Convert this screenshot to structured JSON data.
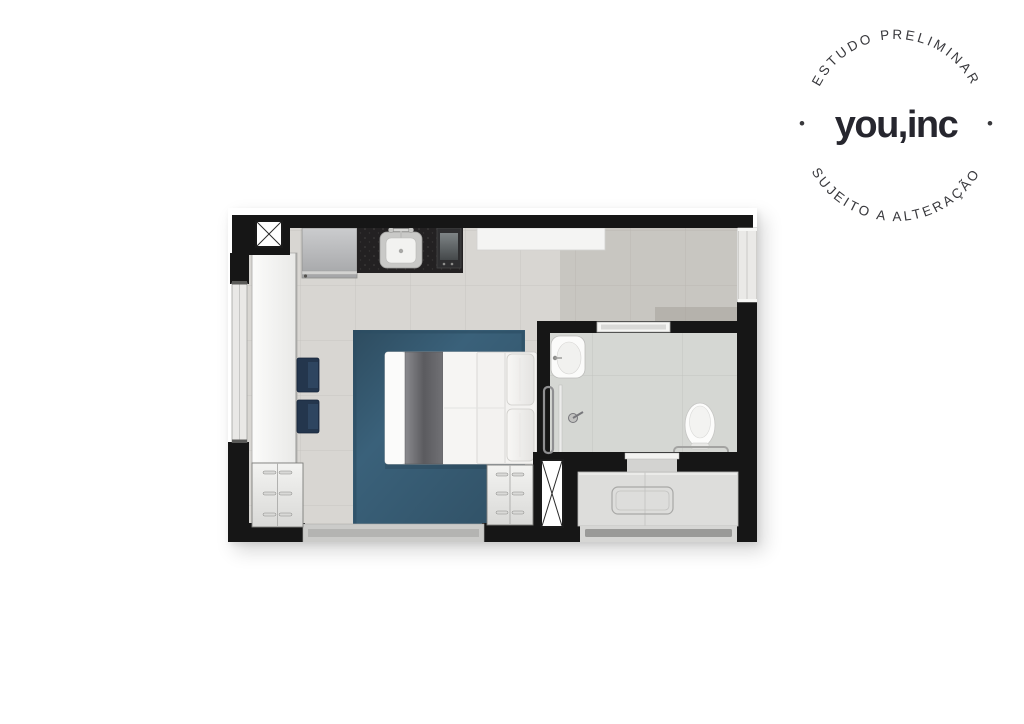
{
  "stamp": {
    "brand": "you,inc",
    "arc_top": "ESTUDO PRELIMINAR",
    "arc_bottom": "SUJEITO A ALTERAÇÃO",
    "separator": "•",
    "text_color": "#38383c",
    "brand_color": "#26262e"
  },
  "floorplan": {
    "colors": {
      "wall": "#161616",
      "floor": "#d8d6d2",
      "bathroom_floor": "#d5d7d3",
      "rug": "#3a617a",
      "granite_counter": "#232122",
      "chair_navy": "#24364d"
    },
    "furniture": [
      "refrigerator",
      "kitchen-sink",
      "cooktop",
      "wall-shelf",
      "wardrobe",
      "chairs",
      "area-rug",
      "double-bed",
      "bed-runner",
      "pillows",
      "nightstand-left",
      "nightstand-right",
      "bathroom-sink",
      "shower",
      "toilet",
      "towel-bar",
      "entry-counter",
      "entry-door-bar",
      "window-left",
      "window-right",
      "window-bottom-sill",
      "bathroom-window",
      "shaft-top-left",
      "shaft-bottom",
      "bathroom-door-opening"
    ]
  }
}
